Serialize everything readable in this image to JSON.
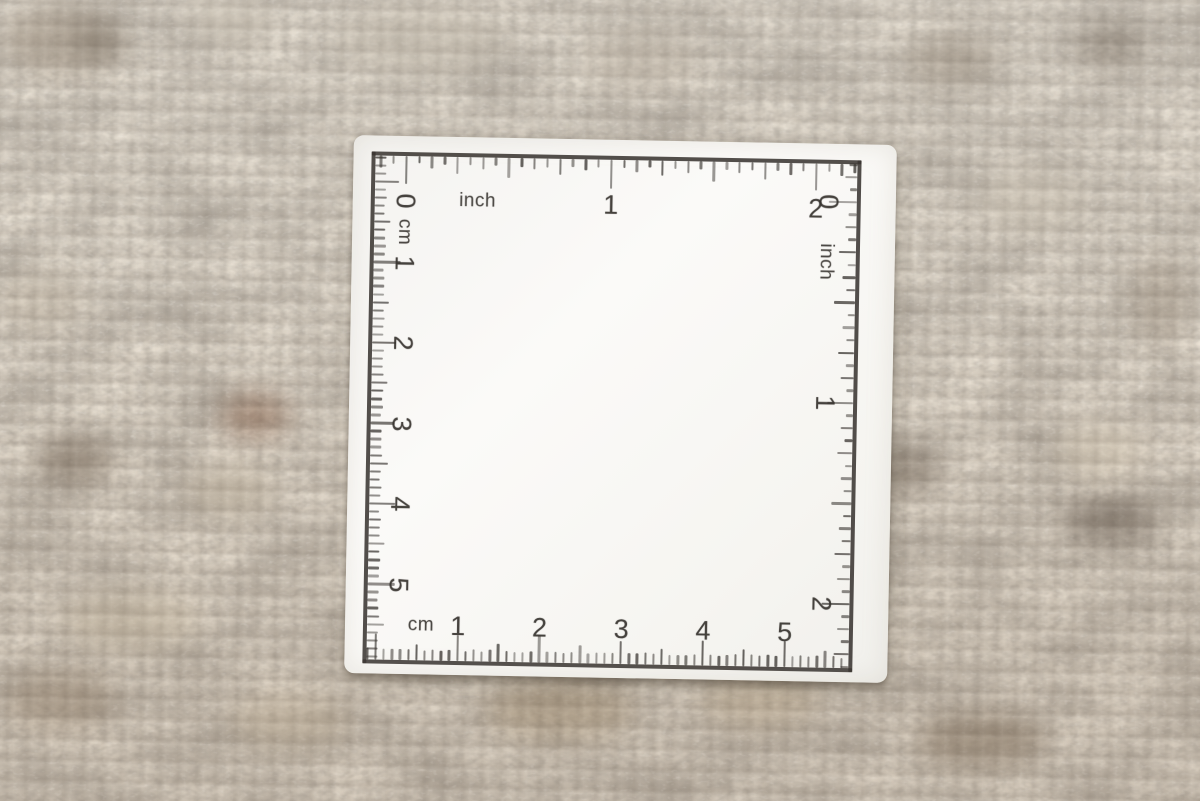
{
  "scene": {
    "type": "photograph",
    "description": "White square measuring-scale card with inch and centimeter rulers printed around its edges, lying on a beige-grey wool loop carpet",
    "colors": {
      "carpet_base": "#ac9f8f",
      "card_white": "#f8f7f4",
      "print_ink": "#3a3733"
    }
  },
  "card": {
    "scales": {
      "top": {
        "unit_label": "inch",
        "numbers": [
          "0",
          "1",
          "2"
        ]
      },
      "right": {
        "unit_label": "inch",
        "numbers": [
          "0",
          "1",
          "2"
        ]
      },
      "left": {
        "unit_label": "cm",
        "numbers": [
          "1",
          "2",
          "3",
          "4",
          "5"
        ]
      },
      "bottom": {
        "unit_label": "cm",
        "numbers": [
          "1",
          "2",
          "3",
          "4",
          "5"
        ]
      }
    }
  }
}
